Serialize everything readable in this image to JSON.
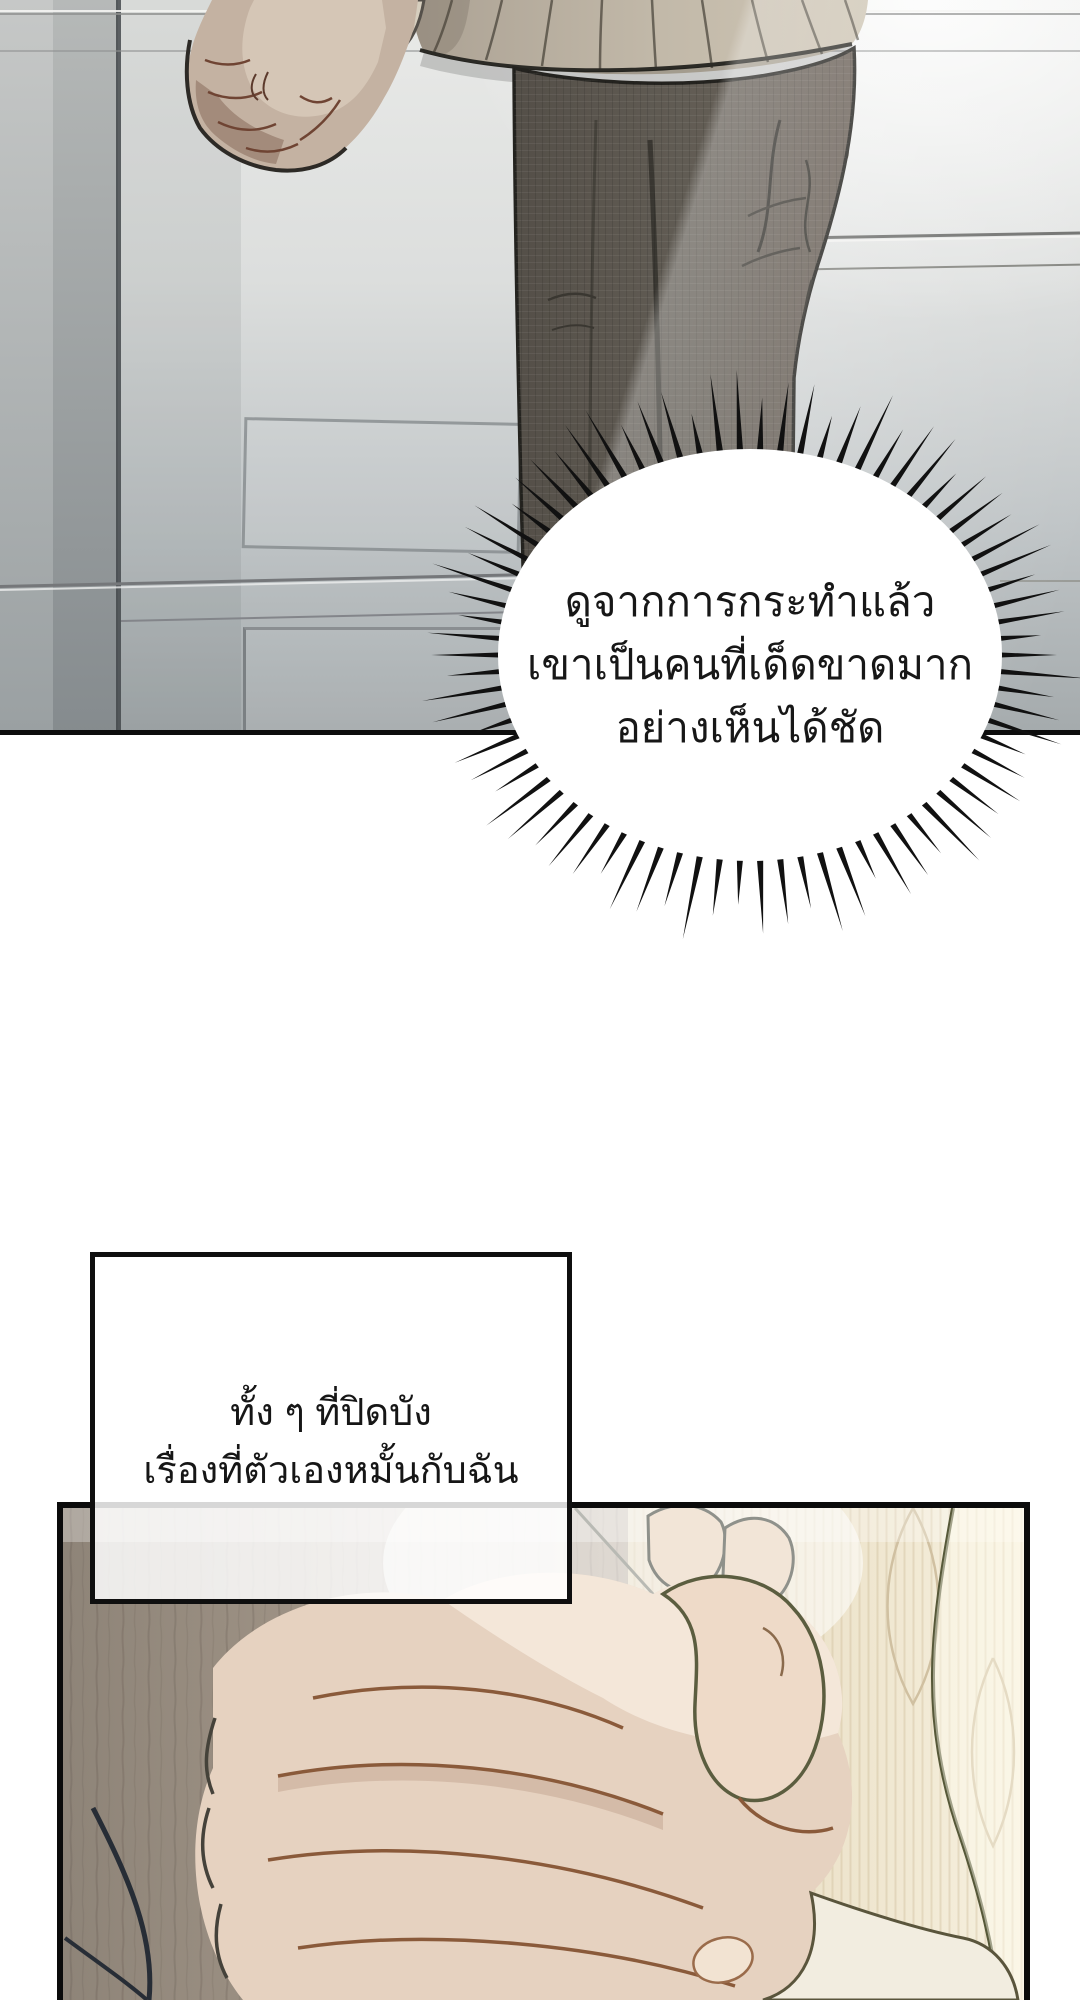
{
  "page": {
    "kind": "webtoon-comic-page",
    "language": "th",
    "background": "#ffffff"
  },
  "speech_bubble": {
    "shape": "spiky-burst",
    "lines": [
      "ดูจากการกระทำแล้ว",
      "เขาเป็นคนที่เด็ดขาดมาก",
      "อย่างเห็นได้ชัด"
    ]
  },
  "caption_box": {
    "shape": "rectangle",
    "lines": [
      "ทั้ง ๆ ที่ปิดบัง",
      "เรื่องที่ตัวเองหมั้นกับฉัน"
    ]
  },
  "colors": {
    "ink": "#0d0d0d",
    "bubble_fill": "#ffffff",
    "caption_fill_rgba": "rgba(255,255,255,0.84)",
    "dresser_light": "#e9eae8",
    "dresser_dark": "#a4aaac",
    "sweater_top": "#b9b0a1",
    "trousers": "#5d5850",
    "skin_light": "#f2e5d7",
    "skin_mid": "#e6d2c0",
    "skin_line": "#8a5a3a",
    "wood_background": "#a3968a",
    "knit_background": "#eee3cb"
  }
}
